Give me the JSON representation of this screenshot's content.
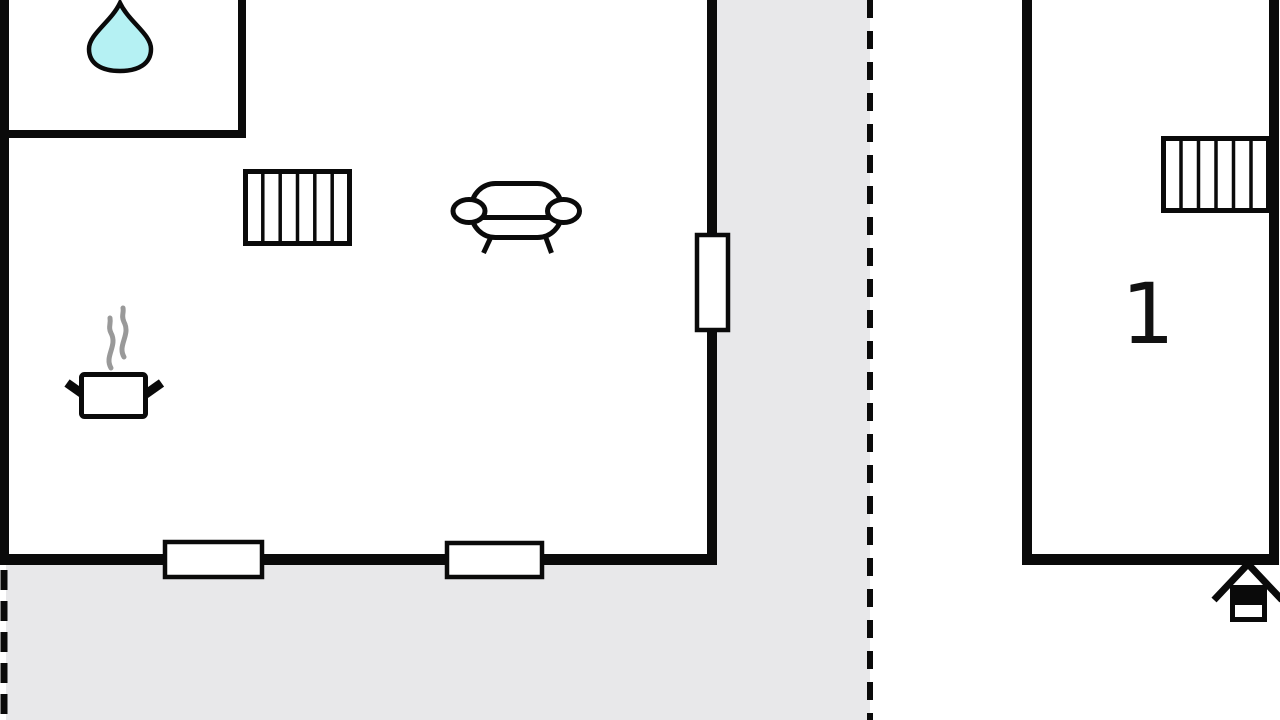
{
  "title": "Floor plan",
  "colors": {
    "background": "#ffffff",
    "wall": "#0a0a0a",
    "terrace": "#e8e8ea",
    "water_drop": "#b5f1f3",
    "steam": "#999999"
  },
  "rooms": {
    "room1": {
      "label": "1"
    }
  },
  "icons": {
    "water-drop": "teardrop glyph (bathroom)",
    "radiator": "rectangle with vertical hatching",
    "sofa": "couch outline with armrests and legs",
    "cooking-pot": "pot with two handles and steam",
    "entrance-house": "small house with gable roof (entrance marker)"
  }
}
